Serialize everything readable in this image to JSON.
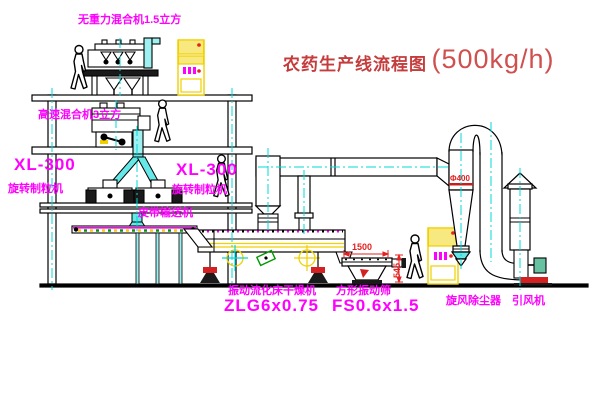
{
  "title": {
    "main": "农药生产线流程图",
    "capacity": "(500kg/h)"
  },
  "labels": {
    "top_mixer": "无重力混合机1.5立方",
    "second_mixer": "高速混合机3立方",
    "granulator_left_model": "XL-300",
    "granulator_left_name": "旋转制粒机",
    "granulator_right_model": "XL-300",
    "granulator_right_name": "旋转制粒机",
    "belt_conveyor": "皮带输送机",
    "dryer_name": "振动流化床干燥机",
    "dryer_model": "ZLG6x0.75",
    "screen_name": "方形振动筛",
    "screen_model": "FS0.6x1.5",
    "cyclone_name": "旋风除尘器",
    "fan_name": "引风机"
  },
  "dimensions": {
    "screen_length": "1500",
    "screen_height": "545",
    "cyclone_marking": "Φ400"
  },
  "colors": {
    "label_magenta": "#ff00ff",
    "title_red": "#c43c3c",
    "dimension_red": "#e32222",
    "centerline_cyan": "#00d8d8",
    "cabinet_yellow": "#f0d000",
    "detail_green": "#009900"
  }
}
